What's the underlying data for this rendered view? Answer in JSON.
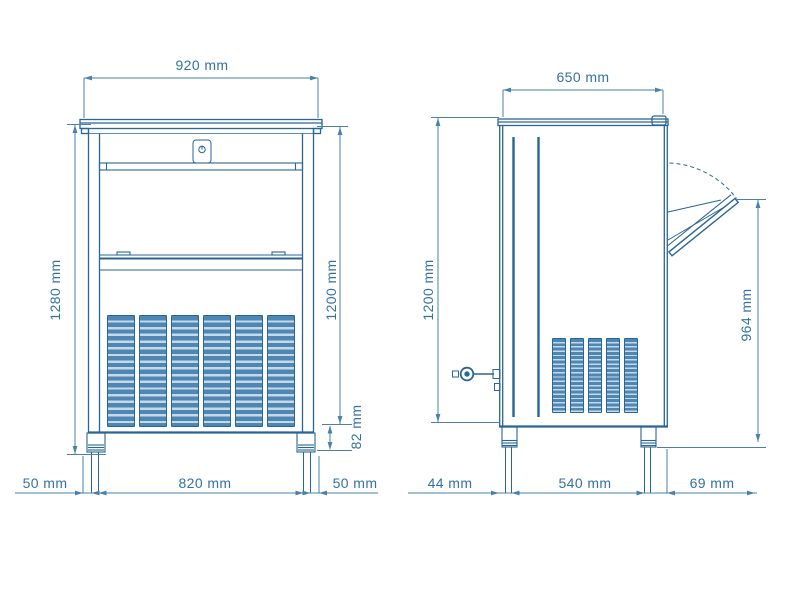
{
  "colors": {
    "outline": "#2a6694",
    "dimension_line": "#4a80aa",
    "text": "#34719f",
    "grille_fill": "#4e86b4",
    "grille_stripe": "#c6d9e8",
    "background": "#ffffff"
  },
  "front_view": {
    "dimensions": {
      "width_overall": "920 mm",
      "height_overall": "1280 mm",
      "height_cabinet": "1200 mm",
      "foot_height": "82 mm",
      "foot_offset_left": "50 mm",
      "feet_spacing": "820 mm",
      "foot_offset_right": "50 mm"
    }
  },
  "side_view": {
    "dimensions": {
      "depth_overall": "650 mm",
      "height_cabinet": "1200 mm",
      "open_door_clearance": "964 mm",
      "foot_offset_front": "44 mm",
      "feet_spacing": "540 mm",
      "foot_offset_rear": "69 mm"
    }
  },
  "icons": {
    "badge_icon": "power-logo-icon"
  }
}
